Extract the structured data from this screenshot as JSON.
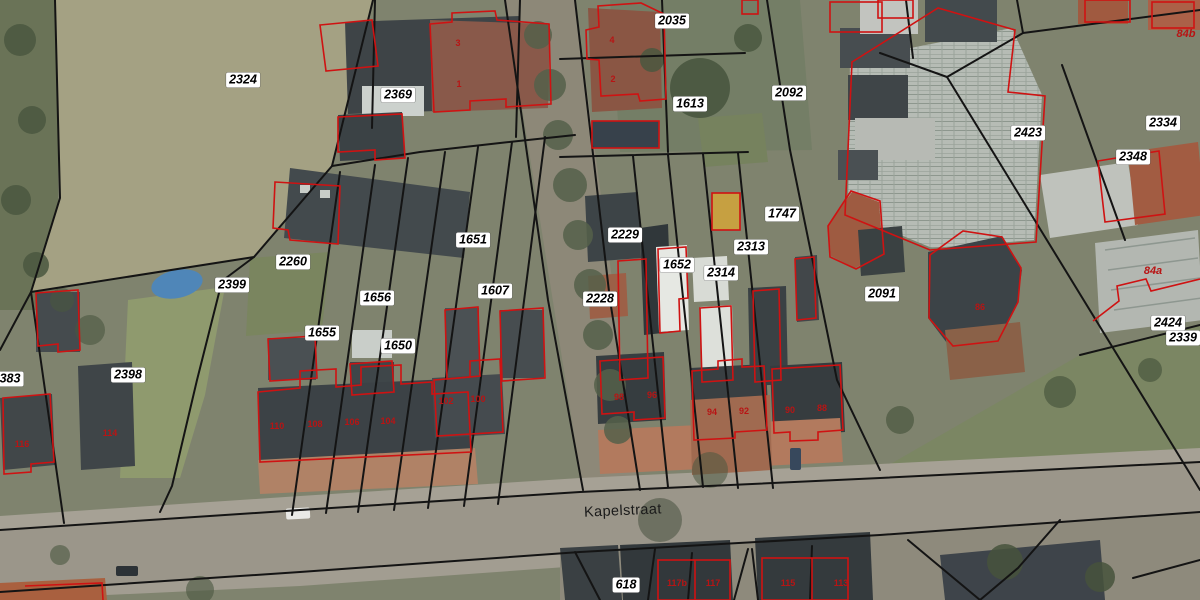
{
  "map": {
    "street_label": "Kapelstraat",
    "colors": {
      "line": "#141414",
      "outline": "#cf1212",
      "labelbg": "#ffffff",
      "labelfg": "#000000",
      "housenum": "#b81414",
      "streetfg": "#1a1a1a"
    },
    "parcel_labels": [
      {
        "t": "2324",
        "x": 243,
        "y": 80
      },
      {
        "t": "2369",
        "x": 398,
        "y": 95
      },
      {
        "t": "2035",
        "x": 672,
        "y": 21
      },
      {
        "t": "1613",
        "x": 690,
        "y": 104
      },
      {
        "t": "2092",
        "x": 789,
        "y": 93
      },
      {
        "t": "2423",
        "x": 1028,
        "y": 133
      },
      {
        "t": "2334",
        "x": 1163,
        "y": 123
      },
      {
        "t": "2348",
        "x": 1133,
        "y": 157
      },
      {
        "t": "2260",
        "x": 293,
        "y": 262
      },
      {
        "t": "2399",
        "x": 232,
        "y": 285
      },
      {
        "t": "1651",
        "x": 473,
        "y": 240
      },
      {
        "t": "1656",
        "x": 377,
        "y": 298
      },
      {
        "t": "1607",
        "x": 495,
        "y": 291
      },
      {
        "t": "1655",
        "x": 322,
        "y": 333
      },
      {
        "t": "1650",
        "x": 398,
        "y": 346
      },
      {
        "t": "2229",
        "x": 625,
        "y": 235
      },
      {
        "t": "1652",
        "x": 677,
        "y": 265
      },
      {
        "t": "2228",
        "x": 600,
        "y": 299
      },
      {
        "t": "2314",
        "x": 721,
        "y": 273
      },
      {
        "t": "2313",
        "x": 751,
        "y": 247
      },
      {
        "t": "1747",
        "x": 782,
        "y": 214
      },
      {
        "t": "2091",
        "x": 882,
        "y": 294
      },
      {
        "t": "2424",
        "x": 1168,
        "y": 323
      },
      {
        "t": "2339",
        "x": 1183,
        "y": 338
      },
      {
        "t": "2398",
        "x": 128,
        "y": 375
      },
      {
        "t": "383",
        "x": 10,
        "y": 379
      },
      {
        "t": "618",
        "x": 626,
        "y": 585
      }
    ],
    "house_numbers": [
      {
        "t": "3",
        "x": 458,
        "y": 43
      },
      {
        "t": "1",
        "x": 459,
        "y": 84
      },
      {
        "t": "4",
        "x": 612,
        "y": 40
      },
      {
        "t": "2",
        "x": 613,
        "y": 79
      },
      {
        "t": "110",
        "x": 277,
        "y": 426
      },
      {
        "t": "108",
        "x": 315,
        "y": 424
      },
      {
        "t": "106",
        "x": 352,
        "y": 422
      },
      {
        "t": "104",
        "x": 388,
        "y": 421
      },
      {
        "t": "102",
        "x": 446,
        "y": 401
      },
      {
        "t": "100",
        "x": 478,
        "y": 399
      },
      {
        "t": "98",
        "x": 619,
        "y": 397
      },
      {
        "t": "96",
        "x": 652,
        "y": 395
      },
      {
        "t": "94",
        "x": 712,
        "y": 412
      },
      {
        "t": "92",
        "x": 744,
        "y": 411
      },
      {
        "t": "90",
        "x": 790,
        "y": 410
      },
      {
        "t": "88",
        "x": 822,
        "y": 408
      },
      {
        "t": "86",
        "x": 980,
        "y": 307
      },
      {
        "t": "116",
        "x": 22,
        "y": 444
      },
      {
        "t": "114",
        "x": 110,
        "y": 433
      },
      {
        "t": "117b",
        "x": 677,
        "y": 583
      },
      {
        "t": "117",
        "x": 713,
        "y": 583
      },
      {
        "t": "115",
        "x": 788,
        "y": 583
      },
      {
        "t": "113",
        "x": 841,
        "y": 583
      }
    ],
    "red_labels": [
      {
        "t": "84b",
        "x": 1186,
        "y": 34
      },
      {
        "t": "84a",
        "x": 1153,
        "y": 271
      }
    ]
  }
}
